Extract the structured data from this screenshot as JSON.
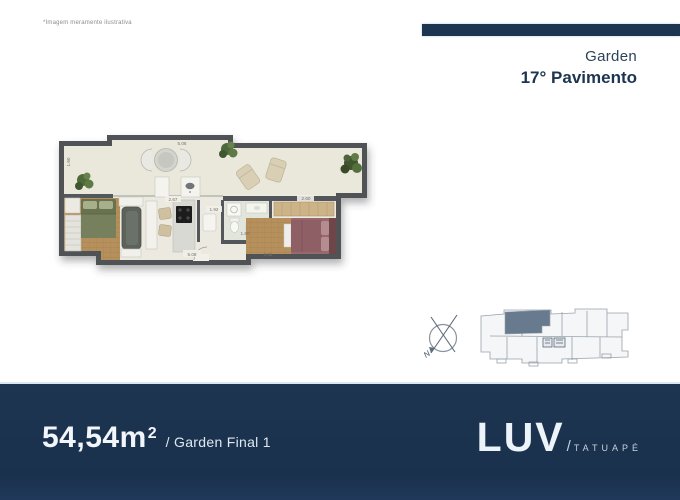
{
  "disclaimer": "*Imagem meramente ilustrativa",
  "header": {
    "program": "Garden",
    "floor": "17° Pavimento"
  },
  "floorplan": {
    "dimensions": {
      "terrace_width": "5.06",
      "terrace_depth": "1.60",
      "kitchen": "2.67",
      "hall": "1.92",
      "bathroom": "1.80",
      "bedroom": "2.60",
      "living_bottom": "5.08",
      "bedroom_bottom": "3.45"
    }
  },
  "keyplan": {
    "compass_label": "N"
  },
  "footer": {
    "area_value": "54,54m",
    "area_exponent": "2",
    "unit_label": "/ Garden Final 1",
    "brand": "LUV",
    "brand_slash": "/",
    "brand_location": "TATUAPÉ"
  },
  "colors": {
    "navy": "#1d3550",
    "heading_navy": "#24384f",
    "wall_gray": "#4f5357",
    "floor_cream": "#ece9e0",
    "wood": "#b6905c",
    "keyplan_highlight": "#687a8e"
  }
}
